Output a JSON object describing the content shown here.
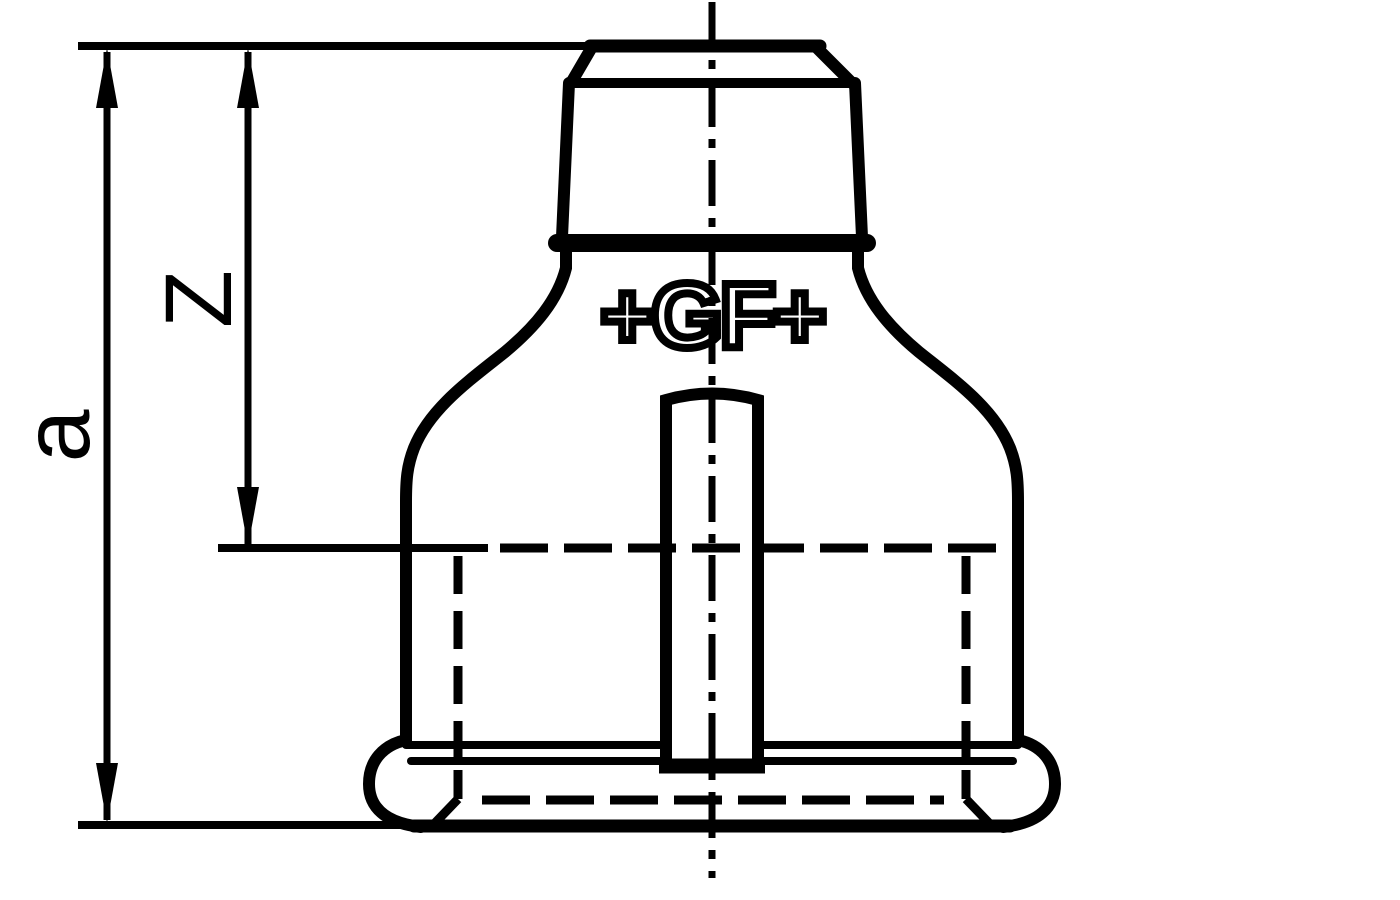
{
  "drawing": {
    "type": "technical-drawing",
    "colors": {
      "line": "#000000",
      "background": "#ffffff"
    },
    "labels": {
      "overall_length": "a",
      "engagement_length": "Z"
    },
    "logo": {
      "manufacturer_mark": "+GF+"
    }
  }
}
